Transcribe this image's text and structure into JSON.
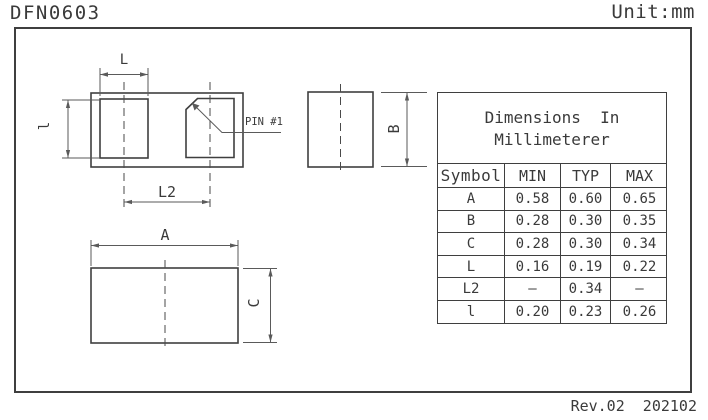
{
  "title": "DFN0603",
  "unit_label": "Unit:mm",
  "revision": "Rev.02  202102",
  "colors": {
    "line": "#3f3f3f",
    "dimension_line": "#5a5a5a",
    "background": "#ffffff"
  },
  "drawing": {
    "labels": {
      "pad_length": "L",
      "pad_width": "l",
      "pad_pitch": "L2",
      "pin1": "PIN #1",
      "body_height": "B",
      "body_length": "A",
      "body_width": "C"
    }
  },
  "table": {
    "title_line1": "Dimensions  In",
    "title_line2": "Millimeterer",
    "columns": [
      "Symbol",
      "MIN",
      "TYP",
      "MAX"
    ],
    "rows": [
      {
        "symbol": "A",
        "min": "0.58",
        "typ": "0.60",
        "max": "0.65"
      },
      {
        "symbol": "B",
        "min": "0.28",
        "typ": "0.30",
        "max": "0.35"
      },
      {
        "symbol": "C",
        "min": "0.28",
        "typ": "0.30",
        "max": "0.34"
      },
      {
        "symbol": "L",
        "min": "0.16",
        "typ": "0.19",
        "max": "0.22"
      },
      {
        "symbol": "L2",
        "min": "–",
        "typ": "0.34",
        "max": "–"
      },
      {
        "symbol": "l",
        "min": "0.20",
        "typ": "0.23",
        "max": "0.26"
      }
    ]
  }
}
